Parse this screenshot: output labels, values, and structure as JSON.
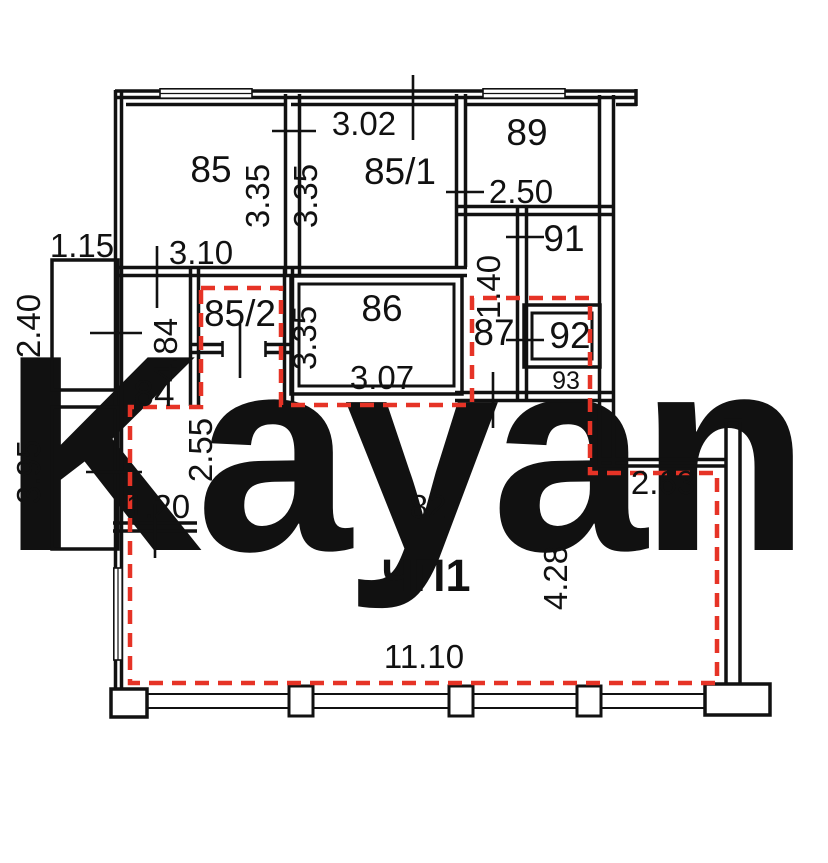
{
  "watermark": {
    "text": "Kayan",
    "color": "#f6cfda"
  },
  "unit": {
    "label": "ЧП1",
    "area_number": "82"
  },
  "rooms": {
    "r85": "85",
    "r85_1": "85/1",
    "r85_2": "85/2",
    "r86": "86",
    "r87": "87",
    "r89": "89",
    "r91": "91",
    "r92": "92",
    "r93": "93",
    "r84": "84"
  },
  "dims": {
    "top_85_1": "3.02",
    "wall_85_right": "3.35",
    "wall_85_1_left": "3.35",
    "wall_86_left": "3.35",
    "r89_width": "2.50",
    "corr_87": "1.40",
    "r85_width": "3.10",
    "r86_width": "3.07",
    "ledge_top": "1.15",
    "ledge_upper": "2.40",
    "ledge_lower": "3.95",
    "corr_84_len": "4.84",
    "passage_85_2": "2.55",
    "r84_bottom": "1.20",
    "hall_width": "11.10",
    "hall_height": "4.28",
    "ledge_right": "2.63"
  },
  "colors": {
    "wall": "#111111",
    "boundary_red": "#e63326",
    "watermark_pink": "#f6cfda"
  }
}
